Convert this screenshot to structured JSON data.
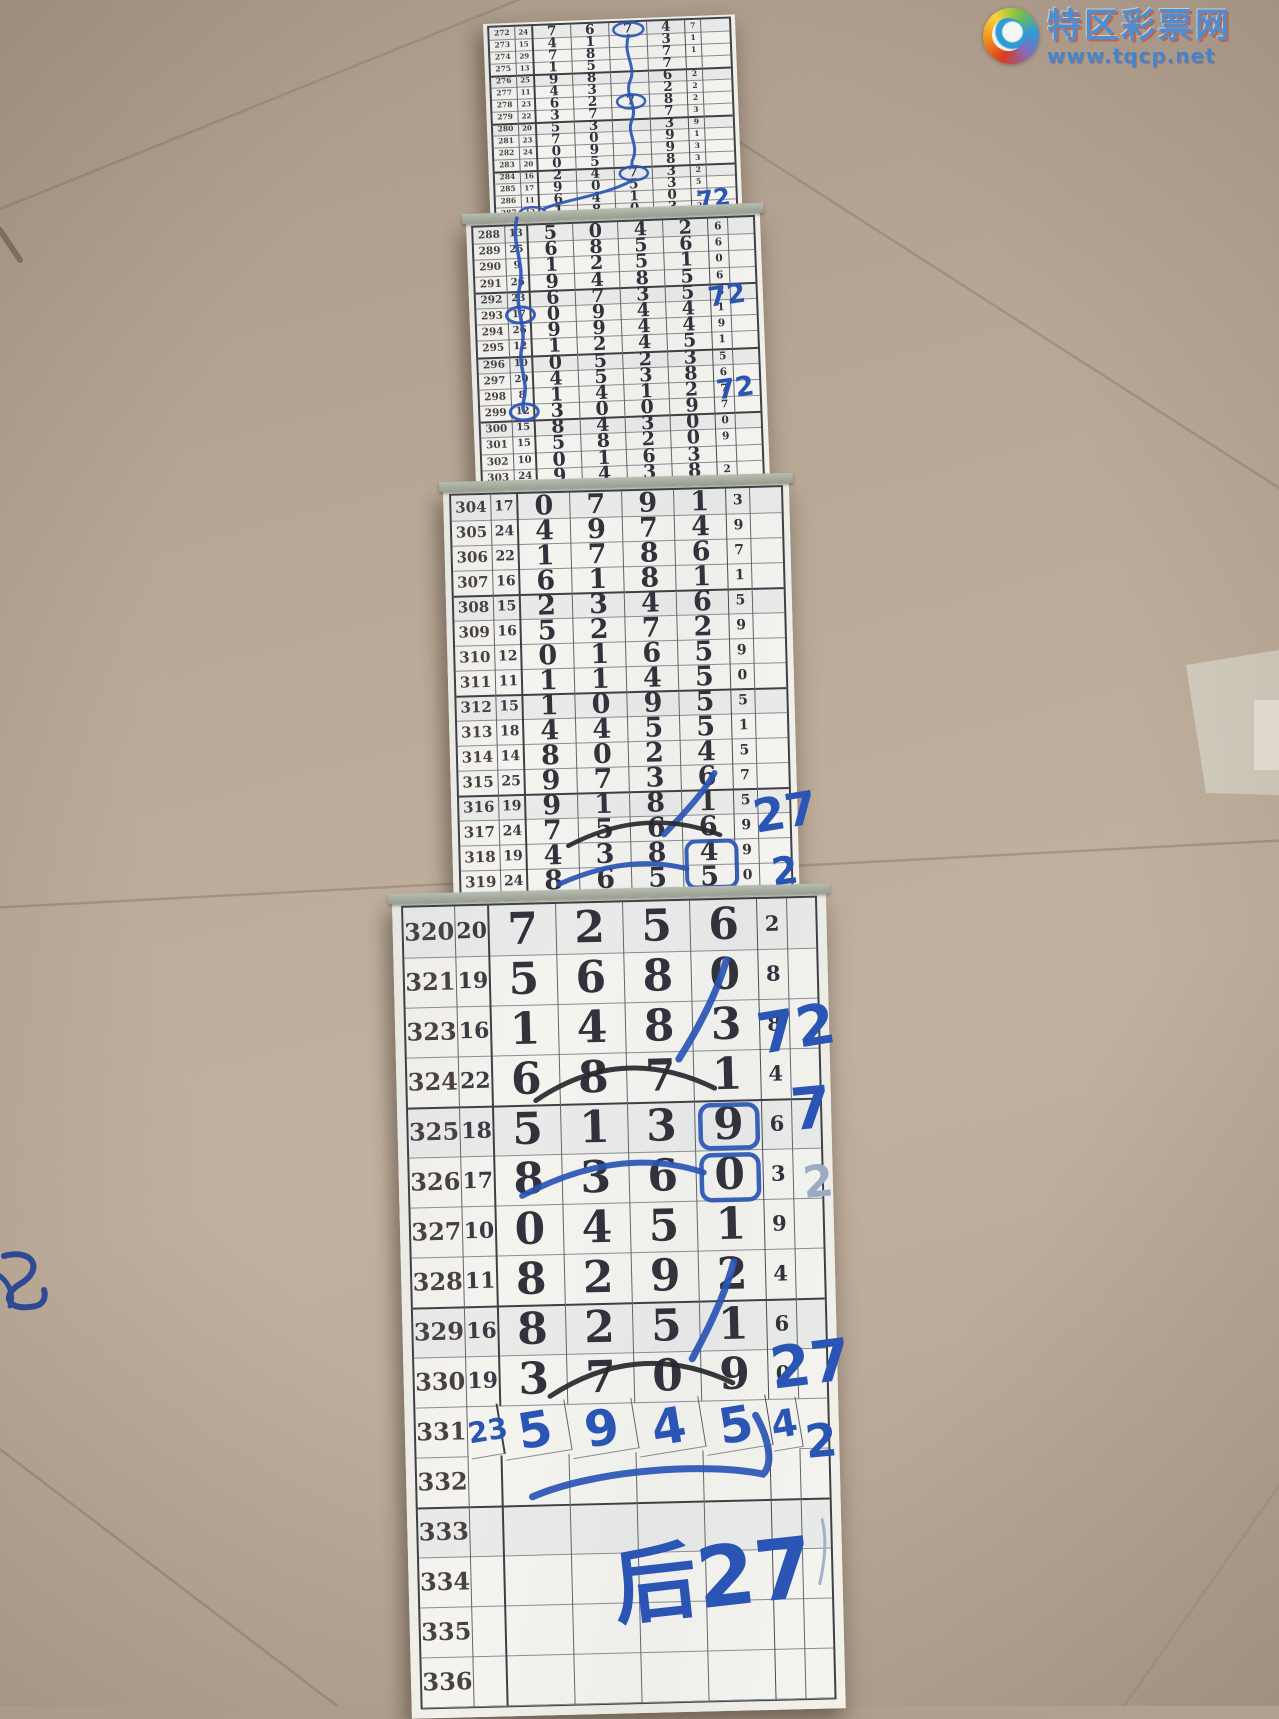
{
  "watermark": {
    "site_name": "特区彩票网",
    "site_url": "www.tqcp.net"
  },
  "table": {
    "columns": [
      "期号",
      "和值",
      "第1位",
      "第2位",
      "第3位",
      "第4位",
      "尾"
    ],
    "note": "lottery draw record strips, rows 272-336"
  },
  "strips": [
    {
      "hw_row": -1,
      "rows": [
        [
          "272",
          "24",
          "7",
          "6",
          "7",
          "4",
          "7"
        ],
        [
          "273",
          "15",
          "4",
          "1",
          "",
          "3",
          "1"
        ],
        [
          "274",
          "29",
          "7",
          "8",
          "",
          "7",
          "1"
        ],
        [
          "275",
          "13",
          "1",
          "5",
          "",
          "7",
          ""
        ],
        [
          "276",
          "25",
          "9",
          "8",
          "",
          "6",
          "2"
        ],
        [
          "277",
          "11",
          "4",
          "3",
          "",
          "2",
          "2"
        ],
        [
          "278",
          "23",
          "6",
          "2",
          "7",
          "8",
          "2"
        ],
        [
          "279",
          "22",
          "3",
          "7",
          "",
          "7",
          "3"
        ],
        [
          "280",
          "20",
          "5",
          "3",
          "",
          "3",
          "9"
        ],
        [
          "281",
          "23",
          "7",
          "0",
          "",
          "9",
          "1"
        ],
        [
          "282",
          "24",
          "0",
          "9",
          "",
          "9",
          "3"
        ],
        [
          "283",
          "20",
          "0",
          "5",
          "",
          "8",
          "3"
        ],
        [
          "284",
          "16",
          "2",
          "4",
          "7",
          "3",
          "2"
        ],
        [
          "285",
          "17",
          "9",
          "0",
          "5",
          "3",
          "5"
        ],
        [
          "286",
          "11",
          "6",
          "4",
          "1",
          "0",
          "2"
        ],
        [
          "287",
          "12",
          "1",
          "8",
          "0",
          "3",
          "2"
        ]
      ],
      "annotations": [
        {
          "type": "ellipse",
          "cx": 139,
          "cy": 7,
          "rx": 15,
          "ry": 7,
          "c": "blue",
          "sw": 2.5
        },
        {
          "type": "ellipse",
          "cx": 139,
          "cy": 79,
          "rx": 14,
          "ry": 7,
          "c": "blue",
          "sw": 2.5
        },
        {
          "type": "ellipse",
          "cx": 139,
          "cy": 151,
          "rx": 14,
          "ry": 7,
          "c": "blue",
          "sw": 2.5
        },
        {
          "type": "path",
          "d": "M139,13 C132,32 146,44 139,58 C132,72 146,84 139,98 C133,110 145,122 139,136 C136,141 138,144 139,145",
          "c": "blue",
          "sw": 3
        },
        {
          "type": "path",
          "d": "M137,158 C110,172 62,176 48,183",
          "c": "blue",
          "sw": 3
        },
        {
          "type": "ellipse",
          "cx": 36,
          "cy": 187,
          "rx": 13,
          "ry": 6,
          "c": "blue",
          "sw": 2.5
        },
        {
          "type": "text",
          "t": "72",
          "x": 202,
          "y": 189,
          "s": 24,
          "c": "blue",
          "r": -6
        }
      ]
    },
    {
      "hw_row": -1,
      "rows": [
        [
          "288",
          "13",
          "5",
          "0",
          "4",
          "2",
          "6"
        ],
        [
          "289",
          "25",
          "6",
          "8",
          "5",
          "6",
          "6"
        ],
        [
          "290",
          "9",
          "1",
          "2",
          "5",
          "1",
          "0"
        ],
        [
          "291",
          "26",
          "9",
          "4",
          "8",
          "5",
          "6"
        ],
        [
          "292",
          "23",
          "6",
          "7",
          "3",
          "5",
          "8"
        ],
        [
          "293",
          "17",
          "0",
          "9",
          "4",
          "4",
          "1"
        ],
        [
          "294",
          "26",
          "9",
          "9",
          "4",
          "4",
          "9"
        ],
        [
          "295",
          "12",
          "1",
          "2",
          "4",
          "5",
          "1"
        ],
        [
          "296",
          "10",
          "0",
          "5",
          "2",
          "3",
          "5"
        ],
        [
          "297",
          "20",
          "4",
          "5",
          "3",
          "8",
          "6"
        ],
        [
          "298",
          "8",
          "1",
          "4",
          "1",
          "2",
          "7"
        ],
        [
          "299",
          "12",
          "3",
          "0",
          "0",
          "9",
          "7"
        ],
        [
          "300",
          "15",
          "8",
          "4",
          "3",
          "0",
          "0"
        ],
        [
          "301",
          "15",
          "5",
          "8",
          "2",
          "0",
          "9"
        ],
        [
          "302",
          "10",
          "0",
          "1",
          "6",
          "3",
          ""
        ],
        [
          "303",
          "24",
          "9",
          "4",
          "3",
          "8",
          "2"
        ]
      ],
      "annotations": [
        {
          "type": "path",
          "d": "M44,-8 C37,18 51,38 44,62 C38,82 50,100 44,122 C39,140 50,156 44,174 C42,180 43,185 44,186",
          "c": "blue",
          "sw": 3.5
        },
        {
          "type": "ellipse",
          "cx": 44,
          "cy": 89,
          "rx": 14,
          "ry": 8,
          "c": "blue",
          "sw": 3
        },
        {
          "type": "ellipse",
          "cx": 44,
          "cy": 186,
          "rx": 14,
          "ry": 8,
          "c": "blue",
          "sw": 3
        },
        {
          "type": "text",
          "t": "72",
          "x": 233,
          "y": 88,
          "s": 27,
          "c": "blue",
          "r": -6
        },
        {
          "type": "text",
          "t": "72",
          "x": 238,
          "y": 181,
          "s": 27,
          "c": "blue",
          "r": -6
        }
      ]
    },
    {
      "hw_row": -1,
      "rows": [
        [
          "304",
          "17",
          "0",
          "7",
          "9",
          "1",
          "3"
        ],
        [
          "305",
          "24",
          "4",
          "9",
          "7",
          "4",
          "9"
        ],
        [
          "306",
          "22",
          "1",
          "7",
          "8",
          "6",
          "7"
        ],
        [
          "307",
          "16",
          "6",
          "1",
          "8",
          "1",
          "1"
        ],
        [
          "308",
          "15",
          "2",
          "3",
          "4",
          "6",
          "5"
        ],
        [
          "309",
          "16",
          "5",
          "2",
          "7",
          "2",
          "9"
        ],
        [
          "310",
          "12",
          "0",
          "1",
          "6",
          "5",
          "9"
        ],
        [
          "311",
          "11",
          "1",
          "1",
          "4",
          "5",
          "0"
        ],
        [
          "312",
          "15",
          "1",
          "0",
          "9",
          "5",
          "5"
        ],
        [
          "313",
          "18",
          "4",
          "4",
          "5",
          "5",
          "1"
        ],
        [
          "314",
          "14",
          "8",
          "0",
          "2",
          "4",
          "5"
        ],
        [
          "315",
          "25",
          "9",
          "7",
          "3",
          "6",
          "7"
        ],
        [
          "316",
          "19",
          "9",
          "1",
          "8",
          "1",
          "5"
        ],
        [
          "317",
          "24",
          "7",
          "5",
          "6",
          "6",
          "9"
        ],
        [
          "318",
          "19",
          "4",
          "3",
          "8",
          "4",
          "9"
        ],
        [
          "319",
          "24",
          "8",
          "6",
          "5",
          "5",
          "0"
        ]
      ],
      "annotations": [
        {
          "type": "path",
          "d": "M256,284 C243,306 222,326 204,344",
          "c": "blue",
          "sw": 6
        },
        {
          "type": "path",
          "d": "M108,353 Q185,315 260,346",
          "c": "black",
          "sw": 4.5
        },
        {
          "type": "text",
          "t": "27",
          "x": 296,
          "y": 345,
          "s": 46,
          "c": "blue",
          "r": -8
        },
        {
          "type": "text",
          "t": "2",
          "x": 312,
          "y": 398,
          "s": 38,
          "c": "blue",
          "r": -6
        },
        {
          "type": "rect",
          "x": 226,
          "y": 352,
          "w": 50,
          "h": 46,
          "rx": 9,
          "c": "blue",
          "sw": 4
        },
        {
          "type": "path",
          "d": "M98,391 Q168,362 226,379",
          "c": "blue",
          "sw": 5
        }
      ]
    },
    {
      "hw_row": 10,
      "rows": [
        [
          "320",
          "20",
          "7",
          "2",
          "5",
          "6",
          "2"
        ],
        [
          "321",
          "19",
          "5",
          "6",
          "8",
          "0",
          "8"
        ],
        [
          "323",
          "16",
          "1",
          "4",
          "8",
          "3",
          "8"
        ],
        [
          "324",
          "22",
          "6",
          "8",
          "7",
          "1",
          "4"
        ],
        [
          "325",
          "18",
          "5",
          "1",
          "3",
          "9",
          "6"
        ],
        [
          "326",
          "17",
          "8",
          "3",
          "6",
          "0",
          "3"
        ],
        [
          "327",
          "10",
          "0",
          "4",
          "5",
          "1",
          "9"
        ],
        [
          "328",
          "11",
          "8",
          "2",
          "9",
          "2",
          "4"
        ],
        [
          "329",
          "16",
          "8",
          "2",
          "5",
          "1",
          "6"
        ],
        [
          "330",
          "19",
          "3",
          "7",
          "0",
          "9",
          "0"
        ],
        [
          "331",
          "23",
          "5",
          "9",
          "4",
          "5",
          "4"
        ],
        [
          "332",
          "",
          "",
          "",
          "",
          "",
          ""
        ],
        [
          "333",
          "",
          "",
          "",
          "",
          "",
          ""
        ],
        [
          "334",
          "",
          "",
          "",
          "",
          "",
          ""
        ],
        [
          "335",
          "",
          "",
          "",
          "",
          "",
          ""
        ],
        [
          "336",
          "",
          "",
          "",
          "",
          "",
          ""
        ]
      ],
      "annotations": [
        {
          "type": "path",
          "d": "M322,60 C312,92 292,128 272,158",
          "c": "blue",
          "sw": 7
        },
        {
          "type": "path",
          "d": "M128,196 Q215,140 307,188",
          "c": "black",
          "sw": 5
        },
        {
          "type": "text",
          "t": "72",
          "x": 354,
          "y": 155,
          "s": 56,
          "c": "blue",
          "r": -8
        },
        {
          "type": "rect",
          "x": 292,
          "y": 205,
          "w": 57,
          "h": 43,
          "rx": 10,
          "c": "blue",
          "sw": 4.5
        },
        {
          "type": "rect",
          "x": 292,
          "y": 255,
          "w": 57,
          "h": 45,
          "rx": 10,
          "c": "blue",
          "sw": 4.5
        },
        {
          "type": "path",
          "d": "M112,291 Q210,242 294,272",
          "c": "blue",
          "sw": 6
        },
        {
          "type": "text",
          "t": "7",
          "x": 384,
          "y": 232,
          "s": 58,
          "c": "blue",
          "r": -4
        },
        {
          "type": "text",
          "t": "2",
          "x": 394,
          "y": 300,
          "s": 44,
          "c": "faint",
          "r": -4
        },
        {
          "type": "path",
          "d": "M322,362 C312,396 294,430 278,458",
          "c": "blue",
          "sw": 7
        },
        {
          "type": "path",
          "d": "M135,492 Q225,436 318,483",
          "c": "black",
          "sw": 5
        },
        {
          "type": "text",
          "t": "27",
          "x": 358,
          "y": 490,
          "s": 58,
          "c": "blue",
          "r": -6
        },
        {
          "type": "text",
          "t": "2",
          "x": 390,
          "y": 560,
          "s": 46,
          "c": "blue",
          "r": -4
        },
        {
          "type": "path",
          "d": "M115,592 C180,566 292,562 346,575 C358,564 351,536 340,516",
          "c": "blue",
          "sw": 7
        },
        {
          "type": "text",
          "t": "后27",
          "x": 196,
          "y": 715,
          "s": 84,
          "c": "blue",
          "r": -5
        },
        {
          "type": "path",
          "d": "M404,622 C409,646 404,670 400,686",
          "c": "faint",
          "sw": 3
        }
      ]
    }
  ]
}
